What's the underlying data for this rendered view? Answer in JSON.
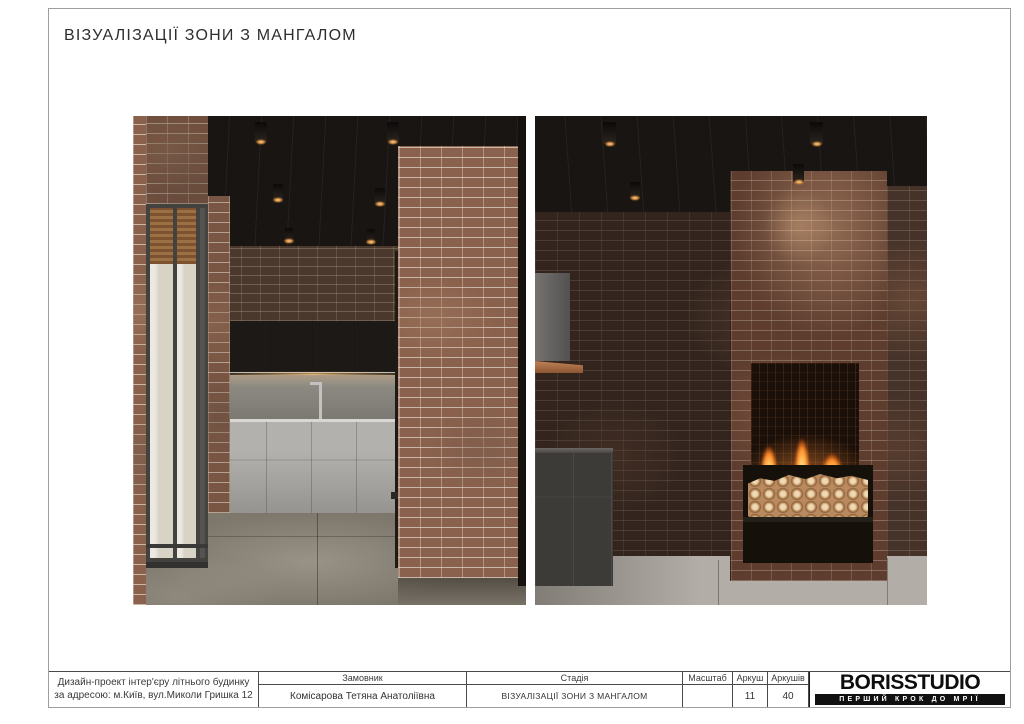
{
  "page": {
    "title": "ВІЗУАЛІЗАЦІЇ ЗОНИ З МАНГАЛОМ"
  },
  "titleblock": {
    "project": {
      "line1": "Дизайн-проект інтер'єру літнього будинку",
      "line2": "за адресою: м.Київ, вул.Миколи Гришка 12"
    },
    "client": {
      "label": "Замовник",
      "value": "Комісарова Тетяна Анатоліївна"
    },
    "stage": {
      "label": "Стадія",
      "value": "ВІЗУАЛІЗАЦІЇ ЗОНИ З МАНГАЛОМ"
    },
    "scale": {
      "label": "Масштаб",
      "value": ""
    },
    "sheet": {
      "label": "Аркуш",
      "value": "11"
    },
    "sheets": {
      "label": "Аркушів",
      "value": "40"
    },
    "brand": {
      "name": "BORISSTUDIO",
      "tagline": "ПЕРШИЙ КРОК ДО МРІЇ"
    }
  },
  "colors": {
    "logo_bar": "#111111",
    "fire_accent": "#ff9e2a",
    "brick_light": "#8a614c",
    "brick_dark": "#33251e",
    "ceiling": "#181512"
  }
}
